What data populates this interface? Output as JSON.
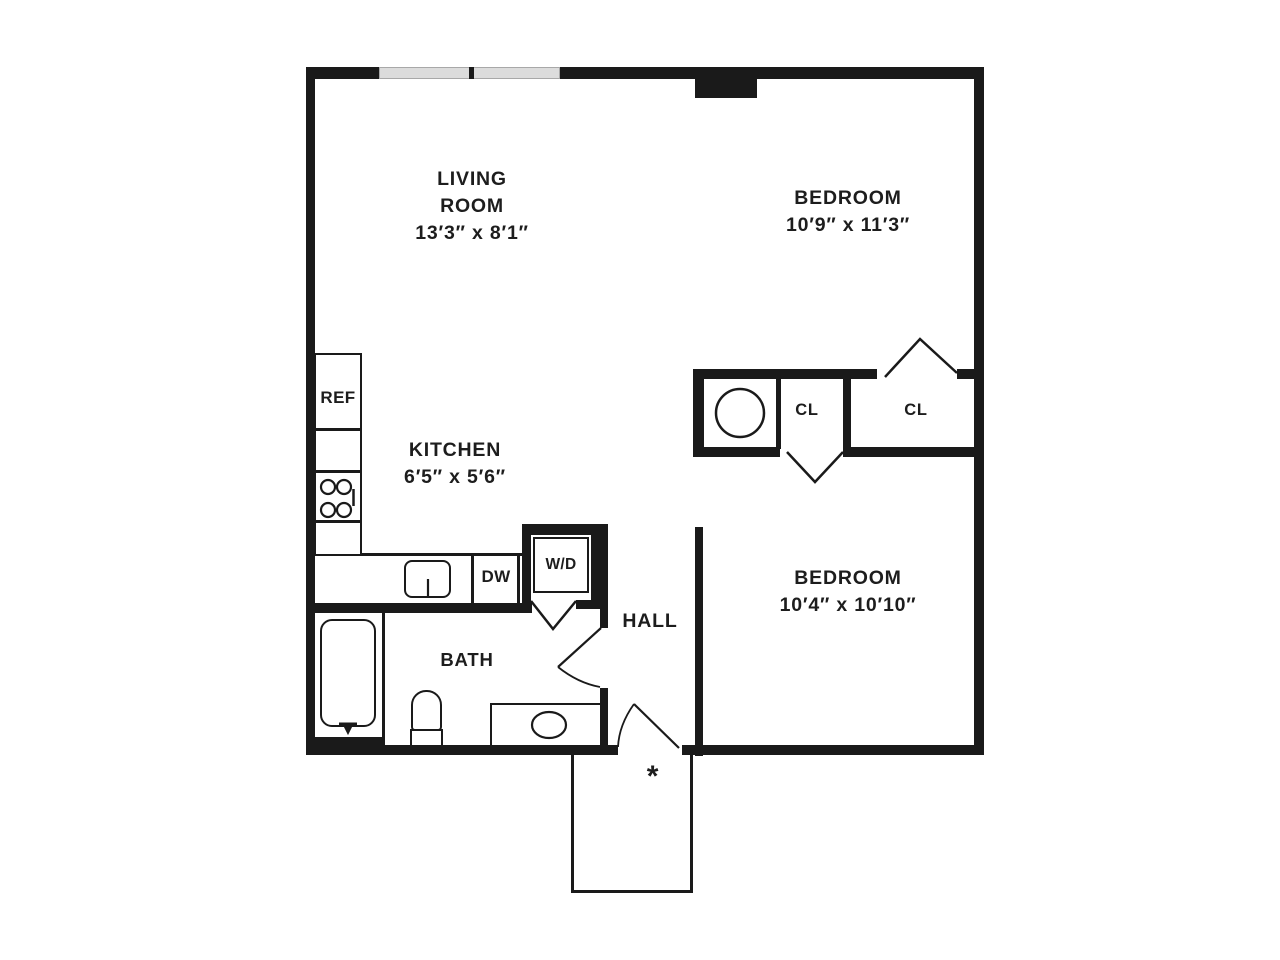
{
  "rooms": {
    "living_room": {
      "label_line1": "LIVING",
      "label_line2": "ROOM",
      "dimensions": "13′3″ x 8′1″"
    },
    "bedroom_top": {
      "label": "BEDROOM",
      "dimensions": "10′9″ x 11′3″"
    },
    "bedroom_bottom": {
      "label": "BEDROOM",
      "dimensions": "10′4″ x 10′10″"
    },
    "kitchen": {
      "label": "KITCHEN",
      "dimensions": "6′5″ x 5′6″"
    },
    "bath": {
      "label": "BATH"
    },
    "hall": {
      "label": "HALL"
    }
  },
  "fixtures": {
    "refrigerator": "REF",
    "dishwasher": "DW",
    "washer_dryer": "W/D",
    "closet_small": "CL",
    "closet_large": "CL",
    "entry_marker": "*"
  },
  "colors": {
    "line": "#1a1a1a",
    "window_fill": "#dcdcdc",
    "background": "#ffffff"
  }
}
